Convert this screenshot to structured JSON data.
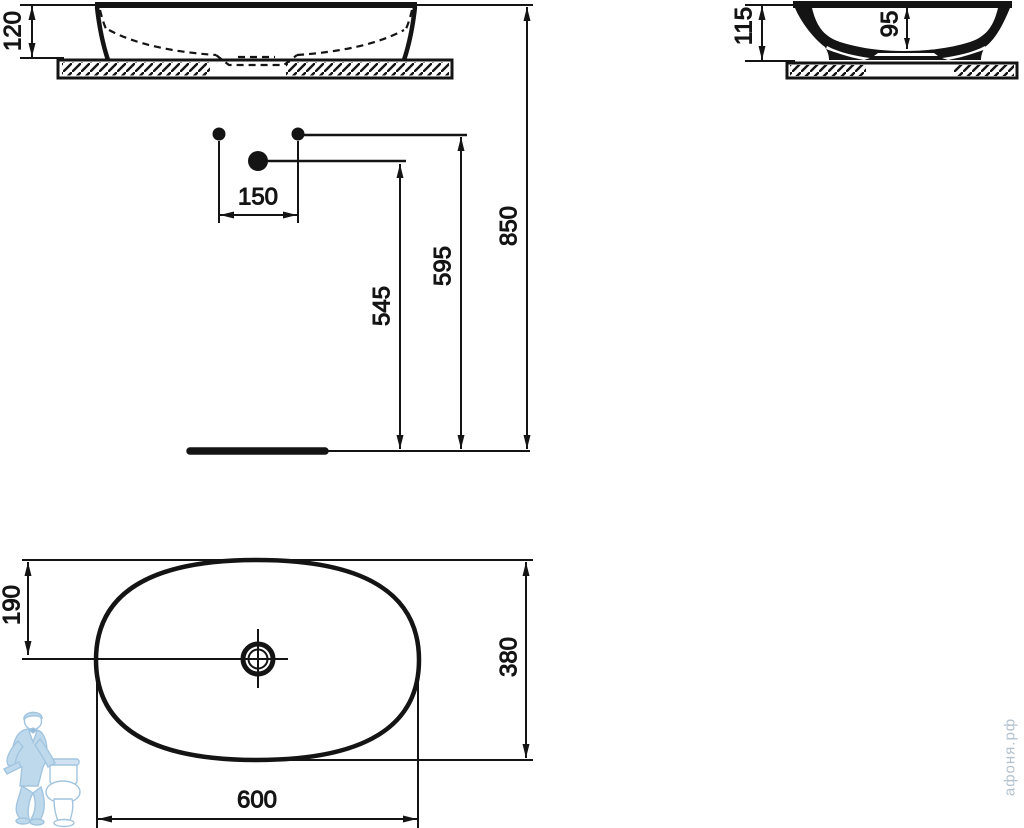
{
  "drawing": {
    "background": "#ffffff",
    "line_color": "#141414",
    "dims": {
      "front_rim_height": "120",
      "side_overall_height": "115",
      "side_bowl_depth": "95",
      "hole_spacing": "150",
      "drain_height": "545",
      "leader_height": "595",
      "rim_height_from_floor": "850",
      "plan_center_offset": "190",
      "plan_depth": "380",
      "plan_width": "600"
    }
  },
  "watermark": {
    "text": "афоня.рф",
    "text_color": "#b3c2cf",
    "logo": "plumber-with-toilet",
    "logo_color": "#bcd7ec"
  }
}
